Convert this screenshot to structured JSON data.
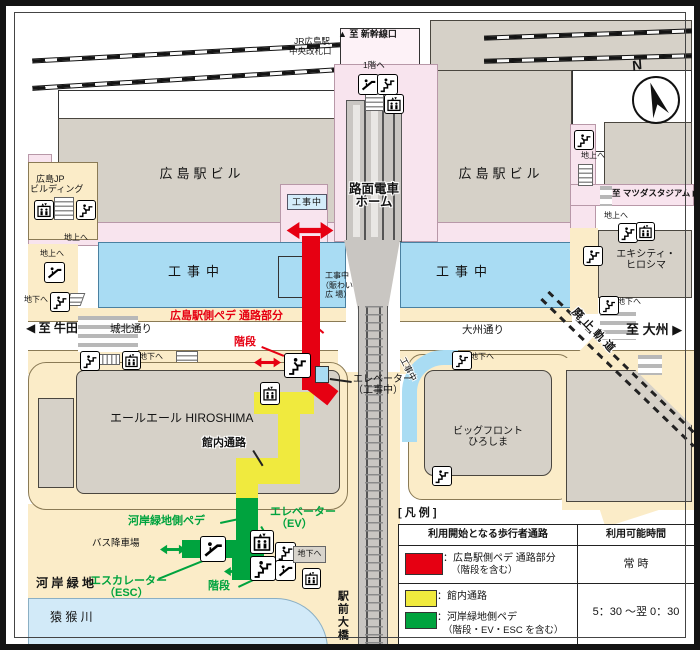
{
  "labels": {
    "north": "N",
    "to_shinkansen": "▲ 至 新幹線口",
    "jr_gate_l1": "JR広島駅",
    "jr_gate_l2": "中央改札口",
    "to_1f": "1階へ",
    "station_bldg": "広島駅ビル",
    "jp_l1": "広島JP",
    "jp_l2": "ビルディング",
    "tram_l1": "路面電車",
    "tram_l2": "ホーム",
    "under_construction": "工事中",
    "nigiwai_l2": "（賑わい",
    "nigiwai_l3": "広 場）",
    "to_ground": "地上へ",
    "to_underground": "地下へ",
    "to_mazda": "至 マツダスタジアム ▶",
    "ekicity_l1": "エキシティ・",
    "ekicity_l2": "ヒロシマ",
    "to_ushita": "◀ 至 牛田",
    "johoku_street": "城北通り",
    "oshu_street": "大州通り",
    "to_ozu": "至 大州 ▶",
    "haishi_kido": "廃止軌道",
    "red_route": "広島駅側ペデ 通路部分",
    "stairs": "階段",
    "elev_uc_l1": "エレベーター",
    "elev_uc_l2": "（工事中）",
    "yale_bldg": "エールエール HIROSHIMA",
    "kannai_tsuro": "館内通路",
    "bigfront_l1": "ビッグフロント",
    "bigfront_l2": "ひろしま",
    "kagan_pede": "河岸緑地側ペデ",
    "ev_l1": "エレベーター",
    "ev_l2": "（EV）",
    "bus_drop": "バス降車場",
    "esc_l1": "エスカレーター",
    "esc_l2": "（ESC）",
    "kagan_ryokuchi": "河 岸 緑 地",
    "enko_river": "猿 猴 川",
    "ekimae_ohashi": "駅前大橋"
  },
  "legend": {
    "title": "[ 凡 例 ]",
    "col_route": "利用開始となる歩行者通路",
    "col_hours": "利用可能時間",
    "r1_label": "：広島駅側ペデ 通路部分",
    "r1_sub": "（階段を含む）",
    "r1_hours": "常 時",
    "r2_label": "：館内通路",
    "r3_label": "：河岸緑地側ペデ",
    "r3_sub": "（階段・EV・ESC を含む）",
    "r23_hours": "5：30 ～翌 0：30"
  },
  "colors": {
    "red": "#e60012",
    "yellow": "#f0ea3e",
    "green": "#00a33e",
    "blue": "#a9dcf3",
    "badge": "#d4ecfa",
    "pink": "#f8e4ee",
    "beige": "#fbecc8",
    "gray": "#d6d1c8",
    "water": "#d2eaf8"
  },
  "icons": [
    "stairs-icon",
    "escalator-icon",
    "elevator-icon",
    "arrow-double-icon",
    "arrow-down-icon",
    "compass-icon"
  ]
}
